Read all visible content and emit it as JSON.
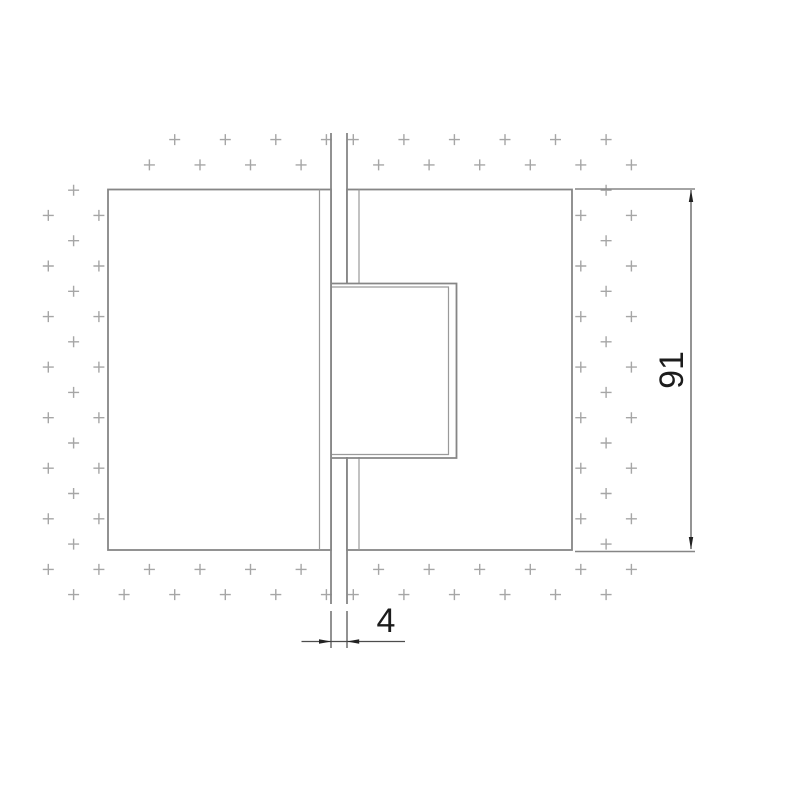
{
  "page": {
    "type": "technical-drawing",
    "description": "Front view of a 180-degree glass-to-glass hinge: two clamp plates on hatched glass panes with a center knuckle, glass gap and overall height dimensions"
  },
  "dimensions": {
    "height_label": "91",
    "gap_label": "4"
  },
  "colors": {
    "bg": "#ffffff",
    "outline": "#868686",
    "detail": "#9a9a9a",
    "cross": "#a6a6a6",
    "dim": "#4d4d4d",
    "arrow": "#222222",
    "txt": "#1c1c1c"
  },
  "cross_pattern": {
    "pitch": 25.28,
    "arm": 5.5,
    "origin_y": 139.6,
    "panes": [
      {
        "name": "left-glass",
        "origin_x": 48.3,
        "parity": "odd",
        "regions": [
          {
            "x": 140,
            "y": 133,
            "w": 192,
            "h": 53
          },
          {
            "x": 42,
            "y": 186,
            "w": 63,
            "h": 419
          },
          {
            "x": 105,
            "y": 560,
            "w": 227,
            "h": 45
          }
        ]
      },
      {
        "name": "right-glass",
        "origin_x": 353.3,
        "parity": "even",
        "regions": [
          {
            "x": 347,
            "y": 133,
            "w": 294,
            "h": 53
          },
          {
            "x": 568,
            "y": 186,
            "w": 73,
            "h": 419
          },
          {
            "x": 347,
            "y": 560,
            "w": 219,
            "h": 45
          }
        ]
      }
    ]
  }
}
